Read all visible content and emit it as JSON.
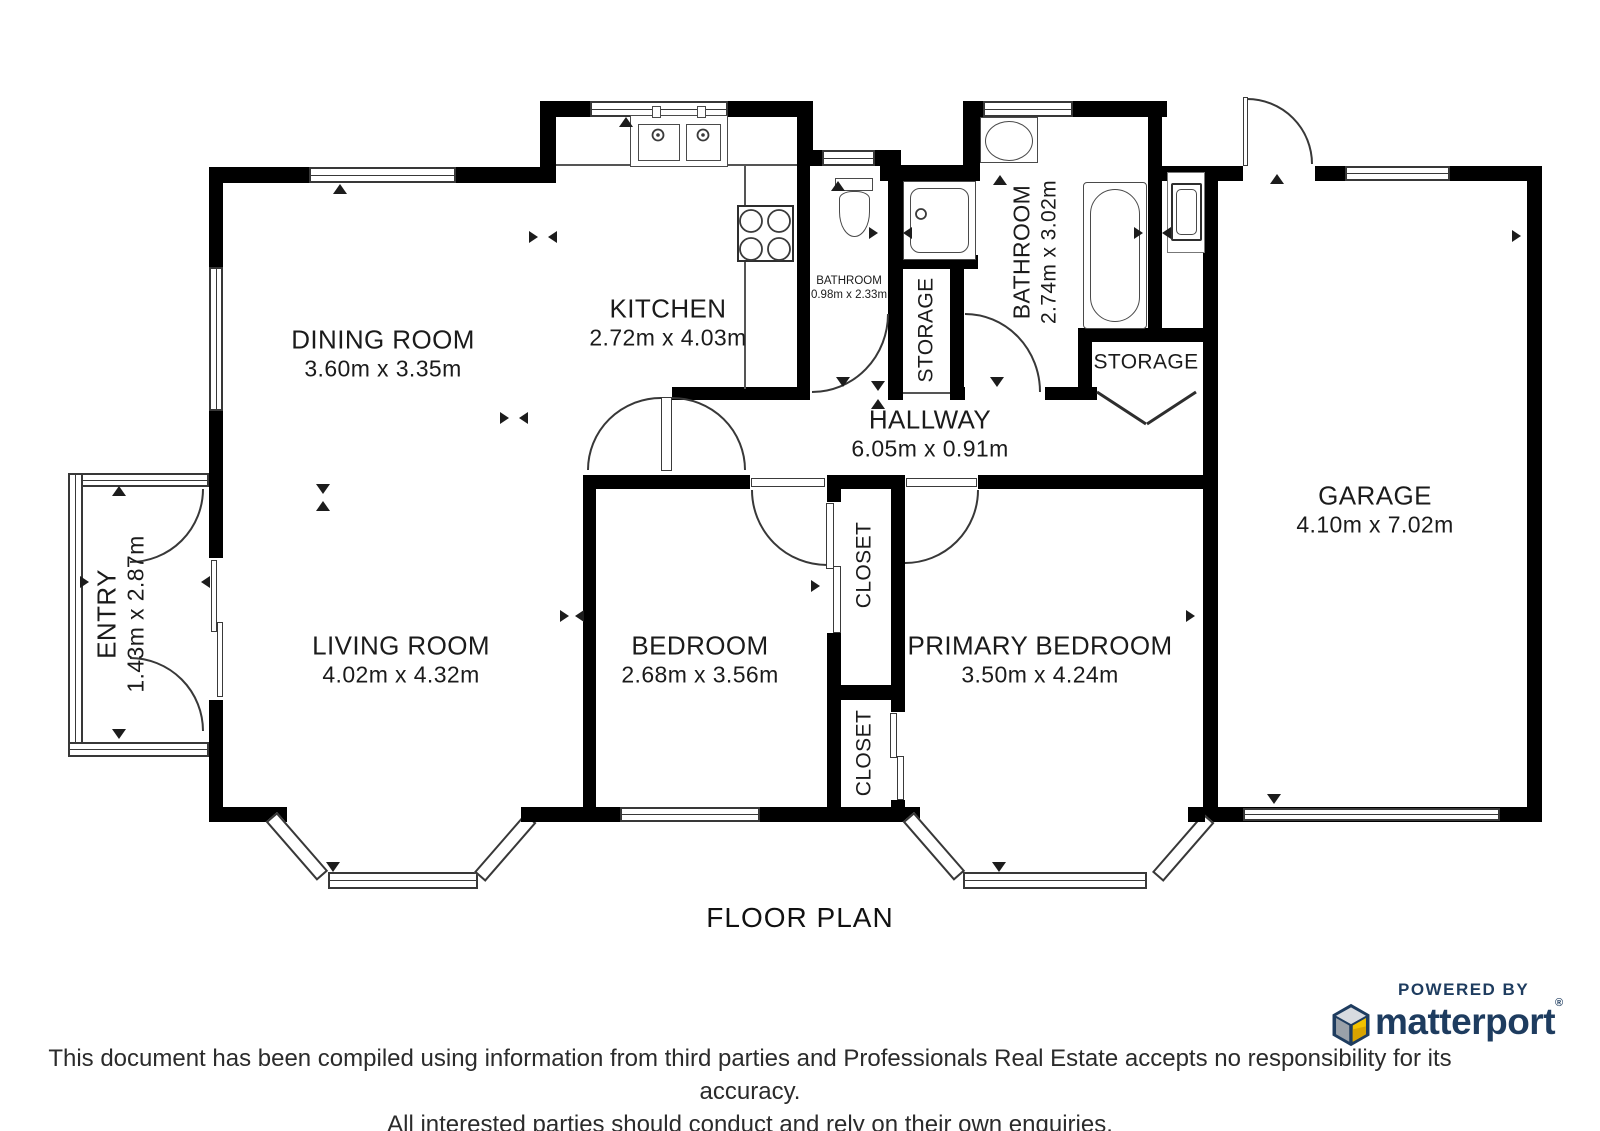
{
  "title": "FLOOR PLAN",
  "rooms": {
    "dining": {
      "name": "DINING ROOM",
      "dims": "3.60m x 3.35m"
    },
    "kitchen": {
      "name": "KITCHEN",
      "dims": "2.72m x 4.03m"
    },
    "bathroom_small": {
      "name": "BATHROOM",
      "dims": "0.98m x 2.33m"
    },
    "storage_1": {
      "name": "STORAGE"
    },
    "bathroom_main": {
      "name": "BATHROOM",
      "dims": "2.74m x 3.02m"
    },
    "storage_2": {
      "name": "STORAGE"
    },
    "hallway": {
      "name": "HALLWAY",
      "dims": "6.05m x 0.91m"
    },
    "garage": {
      "name": "GARAGE",
      "dims": "4.10m x 7.02m"
    },
    "entry": {
      "name": "ENTRY",
      "dims": "1.43m x 2.87m"
    },
    "living": {
      "name": "LIVING ROOM",
      "dims": "4.02m x 4.32m"
    },
    "bedroom": {
      "name": "BEDROOM",
      "dims": "2.68m x 3.56m"
    },
    "closet_1": {
      "name": "CLOSET"
    },
    "closet_2": {
      "name": "CLOSET"
    },
    "primary": {
      "name": "PRIMARY BEDROOM",
      "dims": "3.50m x 4.24m"
    }
  },
  "branding": {
    "powered_by": "POWERED BY",
    "brand": "matterport",
    "registered": "®"
  },
  "disclaimer": {
    "line1": "This document has been compiled using information from third parties and Professionals Real Estate accepts no responsibility for its accuracy.",
    "line2": "All interested parties should conduct and rely on their own enquiries."
  },
  "colors": {
    "wall": "#000000",
    "line": "#383838",
    "brand_navy": "#1e3c5f",
    "cube_yellow": "#f2c200",
    "cube_yellow_dark": "#d9a400",
    "cube_gray_light": "#d8dbe0",
    "cube_gray_dark": "#9aa1a9"
  }
}
